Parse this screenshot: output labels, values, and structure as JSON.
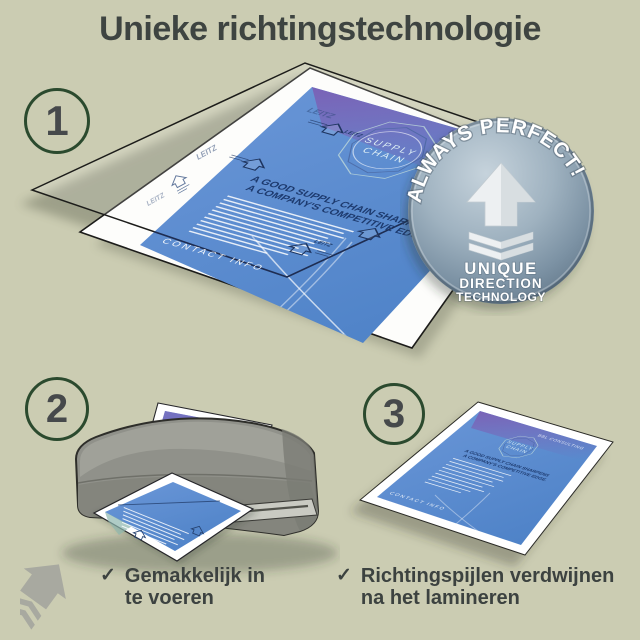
{
  "title": "Unieke richtingstechnologie",
  "steps": {
    "one": "1",
    "two": "2",
    "three": "3"
  },
  "badge": {
    "arc_text": "ALWAYS PERFECT!",
    "line1": "UNIQUE",
    "line2": "DIRECTION",
    "line3": "TECHNOLOGY"
  },
  "doc": {
    "company": "BBL CONSULTING",
    "emblem1": "SUPPLY",
    "emblem2": "CHAIN",
    "heading1": "A GOOD SUPPLY CHAIN SHARPENS",
    "heading2": "A COMPANY'S COMPETITIVE EDGE.",
    "contact": "CONTACT INFO",
    "brand": "LEITZ"
  },
  "checklist": {
    "check": "✓",
    "item1_line1": "Gemakkelijk in",
    "item1_line2": "te voeren",
    "item2_line1": "Richtingspijlen verdwijnen",
    "item2_line2": "na het lamineren"
  },
  "colors": {
    "background": "#cbccb2",
    "heading_text": "#3e4441",
    "circle_ring": "#2b4a2e",
    "badge_steel": "#8ca1b2",
    "document_blue": "#5b8fd2"
  }
}
